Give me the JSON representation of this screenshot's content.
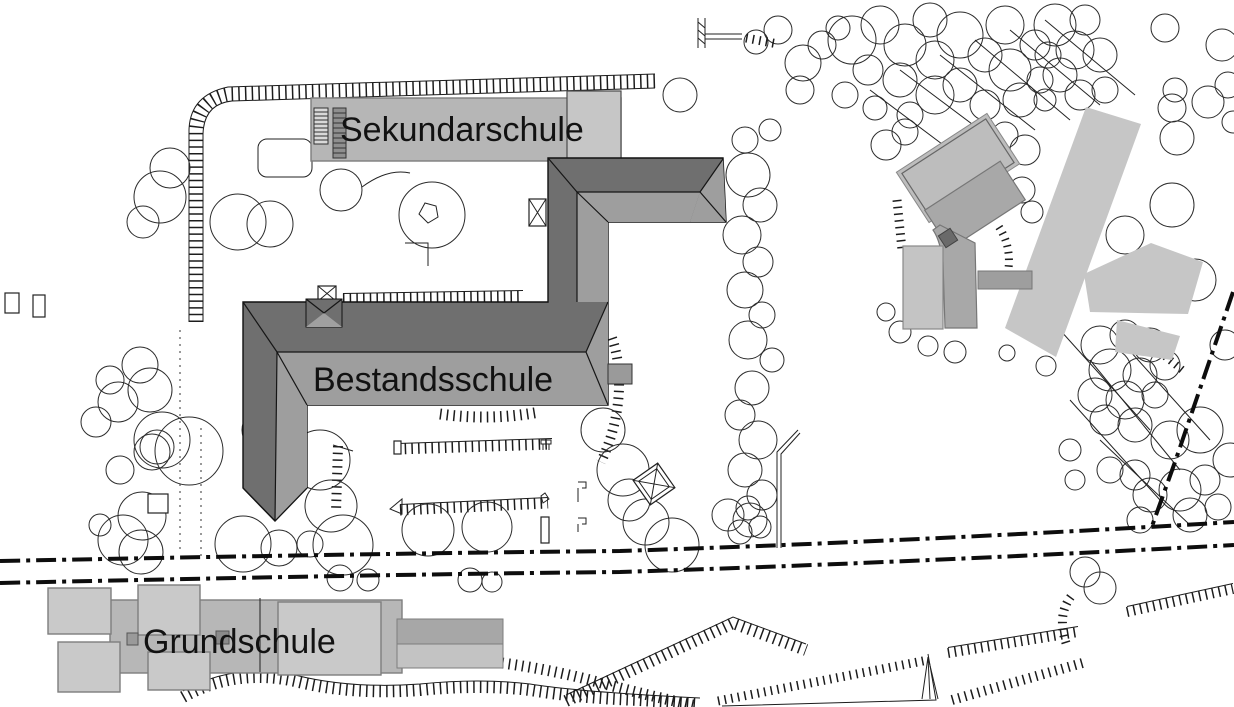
{
  "title": "Lageplan",
  "labels": {
    "sekundarschule": "Sekundarschule",
    "bestandsschule": "Bestandsschule",
    "grundschule": "Grundschule"
  },
  "colors": {
    "background": "#ffffff",
    "sekundar_fill": "#b6b6b6",
    "sekundar_fill_light": "#c6c6c6",
    "roof_dark": "#6f6f6f",
    "roof_light": "#9e9e9e",
    "grund_fill": "#c9c9c9",
    "grund_mid": "#b7b7b7",
    "grund_bar_dark": "#a7a7a7",
    "grund_bar_light": "#c3c3c3",
    "h_building": "#c6c6c6",
    "angled_light": "#bdbdbd",
    "angled_mid": "#a8a8a8",
    "line": "#1a1a1a"
  }
}
